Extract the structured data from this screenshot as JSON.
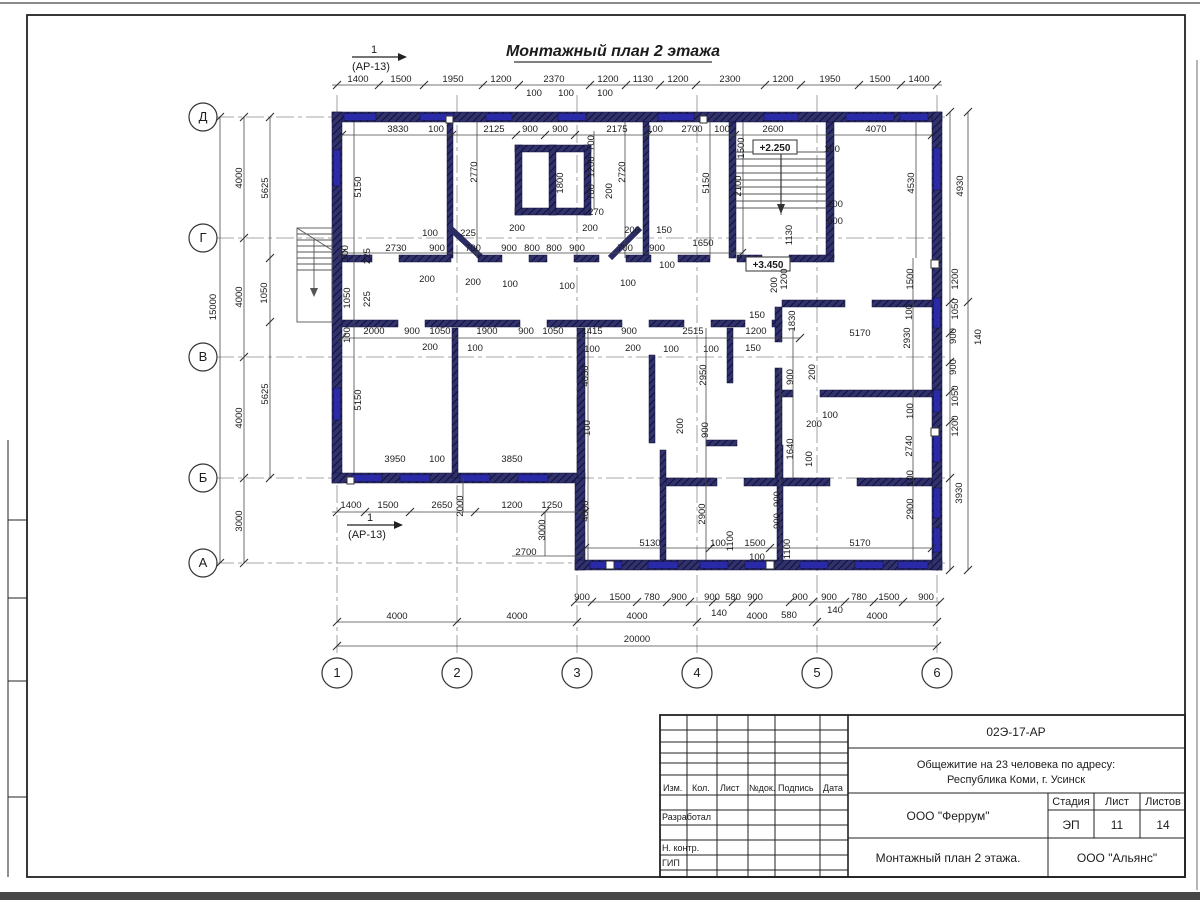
{
  "sheet": {
    "title": "Монтажный план 2 этажа",
    "section_mark": {
      "num": "1",
      "ref": "(АР-13)"
    }
  },
  "axes": {
    "rows": [
      {
        "label": "Д",
        "y": 117
      },
      {
        "label": "Г",
        "y": 238
      },
      {
        "label": "В",
        "y": 357
      },
      {
        "label": "Б",
        "y": 478
      },
      {
        "label": "А",
        "y": 563
      }
    ],
    "cols": [
      {
        "label": "1",
        "x": 337
      },
      {
        "label": "2",
        "x": 457
      },
      {
        "label": "3",
        "x": 577
      },
      {
        "label": "4",
        "x": 697
      },
      {
        "label": "5",
        "x": 817
      },
      {
        "label": "6",
        "x": 937
      }
    ]
  },
  "title_block": {
    "doc_number": "02Э-17-АР",
    "project_line1": "Общежитие на 23 человека по адресу:",
    "project_line2": "Республика Коми, г. Усинск",
    "columns": [
      "Изм.",
      "Кол.",
      "Лист",
      "№док.",
      "Подпись",
      "Дата"
    ],
    "rows": [
      "Разработал",
      "Н. контр.",
      "ГИП"
    ],
    "developer": "ООО \"Феррум\"",
    "stage_label": "Стадия",
    "sheet_label": "Лист",
    "sheets_label": "Листов",
    "stage": "ЭП",
    "sheet": "11",
    "sheets": "14",
    "drawing_name": "Монтажный план 2 этажа.",
    "company": "ООО \"Альянс\""
  },
  "colors": {
    "wall": "#31316b",
    "window": "#2a2aa8",
    "line": "#4a4a4a"
  },
  "dim_labels": [
    {
      "t": "1400",
      "x": 358,
      "y": 82
    },
    {
      "t": "1500",
      "x": 401,
      "y": 82
    },
    {
      "t": "1950",
      "x": 453,
      "y": 82
    },
    {
      "t": "1200",
      "x": 501,
      "y": 82
    },
    {
      "t": "2370",
      "x": 554,
      "y": 82
    },
    {
      "t": "1200",
      "x": 608,
      "y": 82
    },
    {
      "t": "1130",
      "x": 643,
      "y": 82
    },
    {
      "t": "1200",
      "x": 678,
      "y": 82
    },
    {
      "t": "2300",
      "x": 730,
      "y": 82
    },
    {
      "t": "1200",
      "x": 783,
      "y": 82
    },
    {
      "t": "1950",
      "x": 830,
      "y": 82
    },
    {
      "t": "1500",
      "x": 880,
      "y": 82
    },
    {
      "t": "1400",
      "x": 919,
      "y": 82
    },
    {
      "t": "100",
      "x": 534,
      "y": 96
    },
    {
      "t": "100",
      "x": 566,
      "y": 96
    },
    {
      "t": "100",
      "x": 605,
      "y": 96
    },
    {
      "t": "3830",
      "x": 398,
      "y": 132
    },
    {
      "t": "100",
      "x": 436,
      "y": 132
    },
    {
      "t": "2125",
      "x": 494,
      "y": 132
    },
    {
      "t": "900",
      "x": 530,
      "y": 132
    },
    {
      "t": "900",
      "x": 560,
      "y": 132
    },
    {
      "t": "2175",
      "x": 617,
      "y": 132
    },
    {
      "t": "100",
      "x": 655,
      "y": 132
    },
    {
      "t": "2700",
      "x": 692,
      "y": 132
    },
    {
      "t": "100",
      "x": 722,
      "y": 132
    },
    {
      "t": "2600",
      "x": 773,
      "y": 132
    },
    {
      "t": "4070",
      "x": 876,
      "y": 132
    },
    {
      "t": "5150",
      "x": 361,
      "y": 187,
      "r": 1
    },
    {
      "t": "2770",
      "x": 477,
      "y": 172,
      "r": 1
    },
    {
      "t": "1800",
      "x": 563,
      "y": 183,
      "r": 1
    },
    {
      "t": "700",
      "x": 594,
      "y": 143,
      "r": 1
    },
    {
      "t": "1200",
      "x": 594,
      "y": 167,
      "r": 1
    },
    {
      "t": "700",
      "x": 594,
      "y": 192,
      "r": 1
    },
    {
      "t": "200",
      "x": 612,
      "y": 191,
      "r": 1
    },
    {
      "t": "2720",
      "x": 625,
      "y": 172,
      "r": 1
    },
    {
      "t": "5150",
      "x": 709,
      "y": 183,
      "r": 1
    },
    {
      "t": "1500",
      "x": 744,
      "y": 148,
      "r": 1
    },
    {
      "t": "2100",
      "x": 741,
      "y": 186,
      "r": 1
    },
    {
      "t": "4530",
      "x": 914,
      "y": 183,
      "r": 1
    },
    {
      "t": "4930",
      "x": 963,
      "y": 186,
      "r": 1
    },
    {
      "t": "1130",
      "x": 792,
      "y": 235,
      "r": 1
    },
    {
      "t": "1200",
      "x": 787,
      "y": 279,
      "r": 1
    },
    {
      "t": "200",
      "x": 777,
      "y": 285,
      "r": 1
    },
    {
      "t": "1830",
      "x": 795,
      "y": 321,
      "r": 1
    },
    {
      "t": "270",
      "x": 596,
      "y": 215
    },
    {
      "t": "100",
      "x": 832,
      "y": 152
    },
    {
      "t": "200",
      "x": 835,
      "y": 207
    },
    {
      "t": "900",
      "x": 835,
      "y": 224
    },
    {
      "t": "2730",
      "x": 396,
      "y": 251
    },
    {
      "t": "900",
      "x": 437,
      "y": 251
    },
    {
      "t": "700",
      "x": 473,
      "y": 251
    },
    {
      "t": "900",
      "x": 509,
      "y": 251
    },
    {
      "t": "800",
      "x": 532,
      "y": 251
    },
    {
      "t": "800",
      "x": 554,
      "y": 251
    },
    {
      "t": "900",
      "x": 577,
      "y": 251
    },
    {
      "t": "700",
      "x": 625,
      "y": 251
    },
    {
      "t": "900",
      "x": 657,
      "y": 251
    },
    {
      "t": "100",
      "x": 430,
      "y": 236
    },
    {
      "t": "225",
      "x": 468,
      "y": 236
    },
    {
      "t": "200",
      "x": 517,
      "y": 231
    },
    {
      "t": "200",
      "x": 590,
      "y": 231
    },
    {
      "t": "200",
      "x": 632,
      "y": 233
    },
    {
      "t": "150",
      "x": 664,
      "y": 233
    },
    {
      "t": "200",
      "x": 427,
      "y": 282
    },
    {
      "t": "200",
      "x": 473,
      "y": 285
    },
    {
      "t": "100",
      "x": 510,
      "y": 287
    },
    {
      "t": "100",
      "x": 567,
      "y": 289
    },
    {
      "t": "100",
      "x": 628,
      "y": 286
    },
    {
      "t": "100",
      "x": 667,
      "y": 268
    },
    {
      "t": "1650",
      "x": 703,
      "y": 246
    },
    {
      "t": "5170",
      "x": 860,
      "y": 336
    },
    {
      "t": "150",
      "x": 757,
      "y": 318
    },
    {
      "t": "100",
      "x": 348,
      "y": 253,
      "r": 1
    },
    {
      "t": "225",
      "x": 370,
      "y": 256,
      "r": 1
    },
    {
      "t": "1050",
      "x": 350,
      "y": 298,
      "r": 1
    },
    {
      "t": "225",
      "x": 370,
      "y": 299,
      "r": 1
    },
    {
      "t": "100",
      "x": 350,
      "y": 335,
      "r": 1
    },
    {
      "t": "5150",
      "x": 361,
      "y": 400,
      "r": 1
    },
    {
      "t": "15000",
      "x": 216,
      "y": 307,
      "r": 1
    },
    {
      "t": "4000",
      "x": 242,
      "y": 178,
      "r": 1
    },
    {
      "t": "4000",
      "x": 242,
      "y": 297,
      "r": 1
    },
    {
      "t": "4000",
      "x": 242,
      "y": 418,
      "r": 1
    },
    {
      "t": "3000",
      "x": 242,
      "y": 521,
      "r": 1
    },
    {
      "t": "5625",
      "x": 268,
      "y": 188,
      "r": 1
    },
    {
      "t": "1050",
      "x": 267,
      "y": 293,
      "r": 1
    },
    {
      "t": "5625",
      "x": 268,
      "y": 394,
      "r": 1
    },
    {
      "t": "2000",
      "x": 374,
      "y": 334
    },
    {
      "t": "900",
      "x": 412,
      "y": 334
    },
    {
      "t": "1050",
      "x": 440,
      "y": 334
    },
    {
      "t": "1900",
      "x": 487,
      "y": 334
    },
    {
      "t": "900",
      "x": 526,
      "y": 334
    },
    {
      "t": "1050",
      "x": 553,
      "y": 334
    },
    {
      "t": "1415",
      "x": 592,
      "y": 334
    },
    {
      "t": "900",
      "x": 629,
      "y": 334
    },
    {
      "t": "2515",
      "x": 693,
      "y": 334
    },
    {
      "t": "1200",
      "x": 756,
      "y": 334
    },
    {
      "t": "200",
      "x": 430,
      "y": 350
    },
    {
      "t": "100",
      "x": 475,
      "y": 351
    },
    {
      "t": "100",
      "x": 592,
      "y": 352
    },
    {
      "t": "200",
      "x": 633,
      "y": 351
    },
    {
      "t": "100",
      "x": 671,
      "y": 352
    },
    {
      "t": "100",
      "x": 711,
      "y": 352
    },
    {
      "t": "150",
      "x": 753,
      "y": 351
    },
    {
      "t": "4050",
      "x": 588,
      "y": 376,
      "r": 1
    },
    {
      "t": "100",
      "x": 590,
      "y": 428,
      "r": 1
    },
    {
      "t": "2950",
      "x": 706,
      "y": 375,
      "r": 1
    },
    {
      "t": "200",
      "x": 683,
      "y": 426,
      "r": 1
    },
    {
      "t": "900",
      "x": 708,
      "y": 430,
      "r": 1
    },
    {
      "t": "2900",
      "x": 705,
      "y": 514,
      "r": 1
    },
    {
      "t": "1100",
      "x": 733,
      "y": 541,
      "r": 1
    },
    {
      "t": "900",
      "x": 780,
      "y": 499,
      "r": 1
    },
    {
      "t": "900",
      "x": 780,
      "y": 521,
      "r": 1
    },
    {
      "t": "1100",
      "x": 790,
      "y": 549,
      "r": 1
    },
    {
      "t": "900",
      "x": 793,
      "y": 377,
      "r": 1
    },
    {
      "t": "200",
      "x": 815,
      "y": 372,
      "r": 1
    },
    {
      "t": "1640",
      "x": 793,
      "y": 449,
      "r": 1
    },
    {
      "t": "100",
      "x": 812,
      "y": 459,
      "r": 1
    },
    {
      "t": "100",
      "x": 830,
      "y": 418
    },
    {
      "t": "200",
      "x": 814,
      "y": 427
    },
    {
      "t": "1500",
      "x": 913,
      "y": 279,
      "r": 1
    },
    {
      "t": "100",
      "x": 912,
      "y": 312,
      "r": 1
    },
    {
      "t": "2930",
      "x": 910,
      "y": 338,
      "r": 1
    },
    {
      "t": "100",
      "x": 913,
      "y": 411,
      "r": 1
    },
    {
      "t": "2740",
      "x": 912,
      "y": 446,
      "r": 1
    },
    {
      "t": "100",
      "x": 913,
      "y": 478,
      "r": 1
    },
    {
      "t": "2900",
      "x": 913,
      "y": 509,
      "r": 1
    },
    {
      "t": "1200",
      "x": 958,
      "y": 279,
      "r": 1
    },
    {
      "t": "1050",
      "x": 958,
      "y": 309,
      "r": 1
    },
    {
      "t": "900",
      "x": 956,
      "y": 336,
      "r": 1
    },
    {
      "t": "140",
      "x": 981,
      "y": 337,
      "r": 1
    },
    {
      "t": "900",
      "x": 956,
      "y": 367,
      "r": 1
    },
    {
      "t": "1050",
      "x": 958,
      "y": 396,
      "r": 1
    },
    {
      "t": "1200",
      "x": 958,
      "y": 426,
      "r": 1
    },
    {
      "t": "3930",
      "x": 962,
      "y": 493,
      "r": 1
    },
    {
      "t": "3950",
      "x": 395,
      "y": 462
    },
    {
      "t": "100",
      "x": 437,
      "y": 462
    },
    {
      "t": "3850",
      "x": 512,
      "y": 462
    },
    {
      "t": "1400",
      "x": 351,
      "y": 508
    },
    {
      "t": "1500",
      "x": 388,
      "y": 508
    },
    {
      "t": "2650",
      "x": 442,
      "y": 508
    },
    {
      "t": "1200",
      "x": 512,
      "y": 508
    },
    {
      "t": "1250",
      "x": 552,
      "y": 508
    },
    {
      "t": "2000",
      "x": 463,
      "y": 506,
      "r": 1
    },
    {
      "t": "3000",
      "x": 545,
      "y": 530,
      "r": 1
    },
    {
      "t": "4000",
      "x": 588,
      "y": 511,
      "r": 1
    },
    {
      "t": "2700",
      "x": 526,
      "y": 555
    },
    {
      "t": "5130",
      "x": 650,
      "y": 546
    },
    {
      "t": "100",
      "x": 718,
      "y": 546
    },
    {
      "t": "1500",
      "x": 755,
      "y": 546
    },
    {
      "t": "5170",
      "x": 860,
      "y": 546
    },
    {
      "t": "100",
      "x": 757,
      "y": 560
    },
    {
      "t": "900",
      "x": 582,
      "y": 600
    },
    {
      "t": "1500",
      "x": 620,
      "y": 600
    },
    {
      "t": "780",
      "x": 652,
      "y": 600
    },
    {
      "t": "900",
      "x": 679,
      "y": 600
    },
    {
      "t": "900",
      "x": 712,
      "y": 600
    },
    {
      "t": "580",
      "x": 733,
      "y": 600
    },
    {
      "t": "900",
      "x": 755,
      "y": 600
    },
    {
      "t": "900",
      "x": 800,
      "y": 600
    },
    {
      "t": "900",
      "x": 829,
      "y": 600
    },
    {
      "t": "780",
      "x": 859,
      "y": 600
    },
    {
      "t": "1500",
      "x": 889,
      "y": 600
    },
    {
      "t": "900",
      "x": 926,
      "y": 600
    },
    {
      "t": "140",
      "x": 719,
      "y": 616
    },
    {
      "t": "580",
      "x": 789,
      "y": 618
    },
    {
      "t": "140",
      "x": 835,
      "y": 613
    },
    {
      "t": "4000",
      "x": 397,
      "y": 619
    },
    {
      "t": "4000",
      "x": 517,
      "y": 619
    },
    {
      "t": "4000",
      "x": 637,
      "y": 619
    },
    {
      "t": "4000",
      "x": 757,
      "y": 619
    },
    {
      "t": "4000",
      "x": 877,
      "y": 619
    },
    {
      "t": "20000",
      "x": 637,
      "y": 642
    },
    {
      "t": "+2.250",
      "x": 775,
      "y": 151,
      "c": "lv"
    },
    {
      "t": "+3.450",
      "x": 768,
      "y": 268,
      "c": "lv"
    }
  ]
}
